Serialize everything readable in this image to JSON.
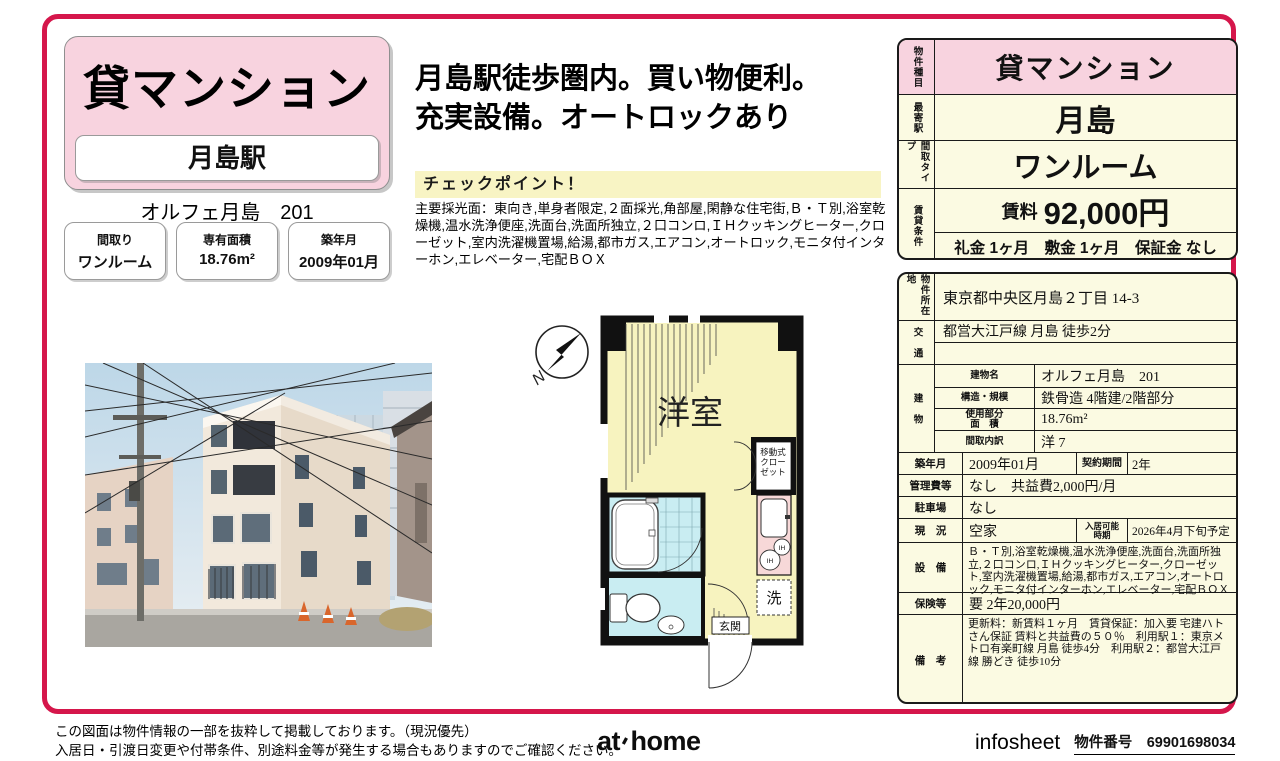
{
  "colors": {
    "accent_frame": "#d5164b",
    "header_pink": "#f8d3df",
    "table_cream": "#fbfae2",
    "checkpoint_yellow": "#f8f4c4",
    "plan_room_yellow": "#f7f3bf",
    "plan_wet_cyan": "#c9edf2",
    "plan_kitchen_pink": "#f7d8d8"
  },
  "left": {
    "property_type": "貸マンション",
    "station": "月島駅",
    "building_title": "オルフェ月島　201",
    "badges": [
      {
        "label": "間取り",
        "value": "ワンルーム"
      },
      {
        "label": "専有面積",
        "value": "18.76m²"
      },
      {
        "label": "築年月",
        "value": "2009年01月"
      }
    ]
  },
  "middle": {
    "headline_line1": "月島駅徒歩圏内。買い物便利。",
    "headline_line2": "充実設備。オートロックあり",
    "checkpoint_label": "チェックポイント！",
    "features": "主要採光面：東向き,単身者限定,２面採光,角部屋,閑静な住宅街,Ｂ・Ｔ別,浴室乾燥機,温水洗浄便座,洗面台,洗面所独立,２口コンロ,ＩＨクッキングヒーター,クローゼット,室内洗濯機置場,給湯,都市ガス,エアコン,オートロック,モニタ付インターホン,エレベーター,宅配ＢＯＸ"
  },
  "floorplan": {
    "room_label": "洋室",
    "closet_lines": {
      "0": "移動式",
      "1": "クロー",
      "2": "ゼット"
    },
    "laundry_label": "洗",
    "entrance_label": "玄関",
    "ih_label": "IH",
    "compass_label": "N"
  },
  "summary": {
    "type_label": "物件種目",
    "type_value": "貸マンション",
    "station_label": "最寄駅",
    "station_value": "月島",
    "layout_label": "間取タイプ",
    "layout_value": "ワンルーム",
    "terms_label": "賃貸条件",
    "rent_label": "賃料",
    "rent_value": "92,000円",
    "terms_value": "礼金 1ヶ月　敷金 1ヶ月　保証金 なし"
  },
  "detail": {
    "location_label": "物件所在地",
    "location": "東京都中央区月島２丁目 14-3",
    "transport_label": "交　通",
    "transport": "都営大江戸線 月島 徒歩2分",
    "building_label": "建　物",
    "bname_label": "建物名",
    "bname": "オルフェ月島　201",
    "structure_label": "構造・規模",
    "structure": "鉄骨造 4階建/2階部分",
    "area_label_1": "使用部分",
    "area_label_2": "面　積",
    "area": "18.76m²",
    "layout_detail_label": "間取内訳",
    "layout_detail": "洋 7",
    "built_label": "築年月",
    "built": "2009年01月",
    "contract_label": "契約期間",
    "contract": "2年",
    "mgmt_label": "管理費等",
    "mgmt": "なし　共益費2,000円/月",
    "parking_label": "駐車場",
    "parking": "なし",
    "status_label": "現　況",
    "status": "空家",
    "movein_label_1": "入居可能",
    "movein_label_2": "時期",
    "movein": "2026年4月下旬予定",
    "equipment_label": "設　備",
    "equipment": "Ｂ・Ｔ別,浴室乾燥機,温水洗浄便座,洗面台,洗面所独立,２口コンロ,ＩＨクッキングヒーター,クローゼット,室内洗濯機置場,給湯,都市ガス,エアコン,オートロック,モニタ付インターホン,エレベーター,宅配ＢＯＸ",
    "insurance_label": "保険等",
    "insurance": "要 2年20,000円",
    "notes_label": "備　考",
    "notes": "更新料：新賃料１ヶ月　賃貸保証：加入要 宅建ハトさん保証 賃料と共益費の５０％　利用駅１：東京メトロ有楽町線 月島 徒歩4分　利用駅２：都営大江戸線 勝どき 徒歩10分"
  },
  "footer": {
    "disclaimer1": "この図面は物件情報の一部を抜粋して掲載しております。（現況優先）",
    "disclaimer2": "入居日・引渡日変更や付帯条件、別途料金等が発生する場合もありますのでご確認ください。",
    "logo_at": "at",
    "logo_home": "home",
    "infosheet": "infosheet",
    "property_no_label": "物件番号",
    "property_no": "69901698034"
  }
}
